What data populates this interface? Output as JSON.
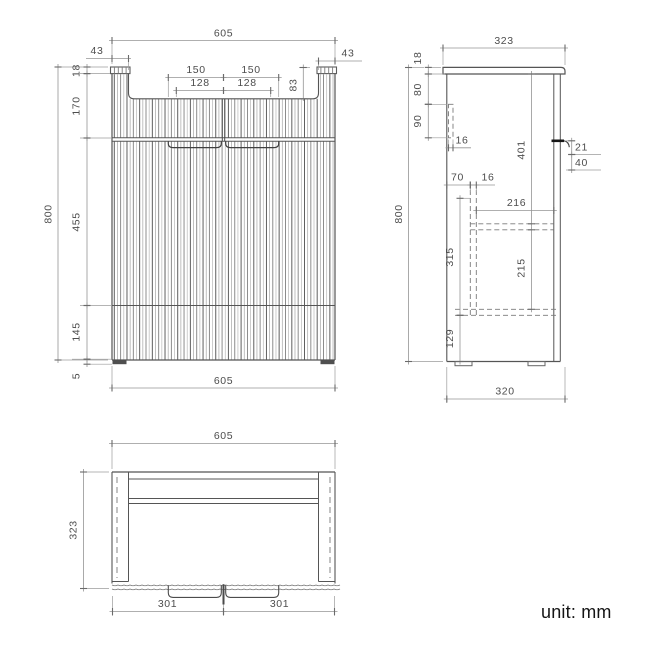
{
  "unit_label": "unit: mm",
  "drawing": {
    "front_view": {
      "dims": [
        {
          "id": "front-width-top",
          "value": "605"
        },
        {
          "id": "front-post-width-left",
          "value": "43"
        },
        {
          "id": "front-post-width-right",
          "value": "43"
        },
        {
          "id": "front-handle-outer-left",
          "value": "150"
        },
        {
          "id": "front-handle-outer-right",
          "value": "150"
        },
        {
          "id": "front-handle-inner-left",
          "value": "128"
        },
        {
          "id": "front-handle-inner-right",
          "value": "128"
        },
        {
          "id": "front-recess-depth",
          "value": "83"
        },
        {
          "id": "front-height-overall",
          "value": "800"
        },
        {
          "id": "front-top-cap",
          "value": "18"
        },
        {
          "id": "front-upper-height",
          "value": "170"
        },
        {
          "id": "front-door-height",
          "value": "455"
        },
        {
          "id": "front-base-height",
          "value": "145"
        },
        {
          "id": "front-foot-height",
          "value": "5"
        },
        {
          "id": "front-width-bottom",
          "value": "605"
        }
      ]
    },
    "side_view": {
      "dims": [
        {
          "id": "side-depth-top",
          "value": "323"
        },
        {
          "id": "side-cap-thickness",
          "value": "18"
        },
        {
          "id": "side-back-gap",
          "value": "80"
        },
        {
          "id": "side-rail-height",
          "value": "90"
        },
        {
          "id": "side-rail-thickness",
          "value": "16"
        },
        {
          "id": "side-partition-offset",
          "value": "70"
        },
        {
          "id": "side-partition-thickness",
          "value": "16"
        },
        {
          "id": "side-shelf-span",
          "value": "216"
        },
        {
          "id": "side-door-height",
          "value": "401"
        },
        {
          "id": "side-handle-depth",
          "value": "21"
        },
        {
          "id": "side-handle-height",
          "value": "40"
        },
        {
          "id": "side-partition-height",
          "value": "315"
        },
        {
          "id": "side-shelf-gap",
          "value": "215"
        },
        {
          "id": "side-base-height",
          "value": "129"
        },
        {
          "id": "side-height-overall",
          "value": "800"
        },
        {
          "id": "side-depth-bottom",
          "value": "320"
        }
      ]
    },
    "plan_view": {
      "dims": [
        {
          "id": "plan-width-top",
          "value": "605"
        },
        {
          "id": "plan-depth",
          "value": "323"
        },
        {
          "id": "plan-door-width-left",
          "value": "301"
        },
        {
          "id": "plan-door-width-right",
          "value": "301"
        }
      ]
    }
  }
}
